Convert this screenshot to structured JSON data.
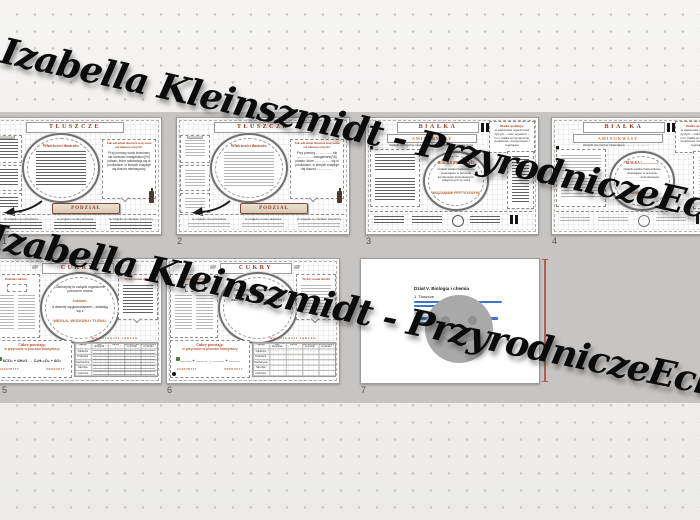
{
  "watermark": {
    "text": "Izabella Kleinszmidt - PrzyrodniczeEcho"
  },
  "colors": {
    "accent": "#8e3b25",
    "insertion_line": "#b85c50",
    "strip_bg": "#c7c5c3"
  },
  "slide_numbers": [
    "1",
    "2",
    "3",
    "4",
    "5",
    "6",
    "7"
  ],
  "tluszcze": {
    "title": "TŁUSZCZE",
    "oval_heading": "Właściwości tłuszczów",
    "side_heading": "Jak odróżnić tłuszcze nasycone od nienasyconych?",
    "side_body_filled": "Przy pomocy wody bromowej lub roztworu manganianu(VII) potasu, które odbarwiają się w produktach, w których znajduje się tłuszcz nienasycony",
    "side_body_blank": "Przy pomocy .................. lub .................. manganianu(VII) potasu, które .................. się w produktach, w których znajduje się tłuszcz ..................",
    "banner": "PODZIAŁ TŁUSZCZÓW",
    "footers": [
      "ze względu na pochodzenie",
      "ze względu na stan skupienia",
      "ze względu na charakter chemiczny"
    ]
  },
  "bialka": {
    "title": "BIAŁKA",
    "subtitle": "AMINOKWASY",
    "note_filled": "Związki chemiczne zawierające grupę aminową i karboksylową",
    "note_blank": "Związki chemiczne zawierające ..............................",
    "corner_heading": "Białka spełniają:",
    "corner_body": "w większości organizmów żywych – nasz organizm – m.in. białka enzymatyczne, budulcowe, transportowe i regulujące",
    "circle_heading_filled": "BIAŁKA (PROTEINY)",
    "circle_heading_blank": "BIAŁKA (.................)",
    "circle_body_filled": "związki wielkocząsteczkowe powstające w procesie kondensacji aminokwasów, połączonych ze sobą",
    "circle_body_blank": "związki wielkocząsteczkowe powstające w procesie .................. aminokwasów ..................",
    "circle_em_filled": "WIĄZANIAMI PEPTYDOWYMI",
    "circle_em_blank": "WIĄZANIAMI ..................."
  },
  "cukry": {
    "title": "CUKRY",
    "podzial_heading": "Podział cukrów",
    "circle_lead": "Sacharydy to związki organiczne potocznie zwane",
    "circle_em1": "cukrami,",
    "circle_mid": "a dawniej węglowodanami – składają się z",
    "circle_em2": "WĘGLA, WODORU i TLENU.",
    "circle_blank": "Sacharydy to związki organiczne potocznie zwane .................., a dawniej .................. – składają się z ..................",
    "side_heading": "Wykrywanie skrobi",
    "bottom_heading": "Cukry powstają:",
    "bottom_sub": "w przyrodzie w procesie fotosyntezy",
    "equation_filled": "6CO₂ + 6H₂O → C₆H₁₂O₆ + 6O₂",
    "equation_blank": ".......... + .......... → .......... + ..........",
    "substraty": "SUBSTRATY",
    "produkty": "PRODUKTY",
    "table_title": "Właściwości cukrów",
    "cols": [
      "Nazwa",
      "Stan skupienia",
      "Barwa",
      "Rozpuszczalność w wodzie",
      "Rozpuszczalność w etanolu"
    ],
    "rows": [
      "Glukoza",
      "Fruktoza",
      "Sacharoza",
      "Skrobia",
      "Celuloza"
    ]
  },
  "final_slide": {
    "heading": "Dział V. Biologia i chemia",
    "item1": "1. Tłuszcze",
    "item2": "2. Białka"
  }
}
